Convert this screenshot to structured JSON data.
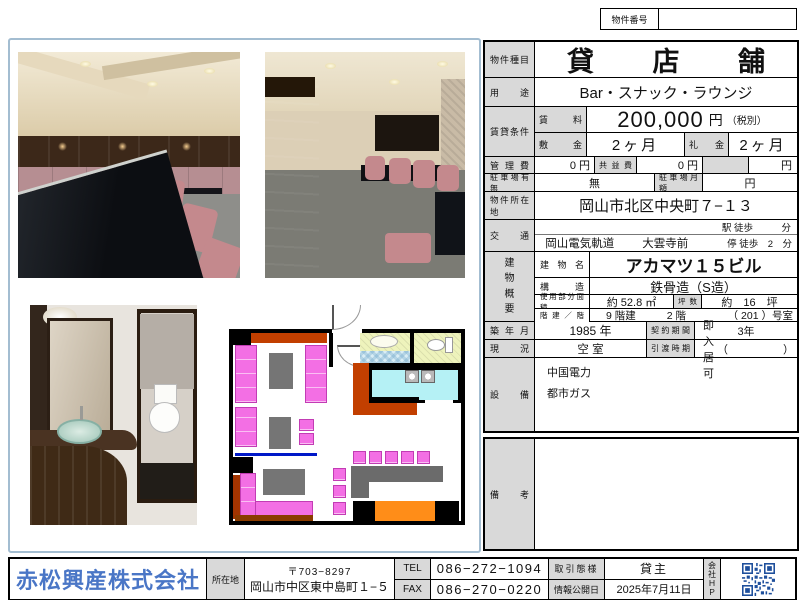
{
  "property_number": {
    "label": "物件番号",
    "value": ""
  },
  "spec": {
    "type_label": "物件種目",
    "type_value": "貸店舗",
    "use_label": "用途",
    "use_value": "Bar・スナック・ラウンジ",
    "rent_label": "賃貸条件",
    "rent_sub_label": "賃料",
    "rent_amount": "200,000",
    "rent_unit": "円",
    "rent_tax_note": "（税別）",
    "deposit_label": "敷金",
    "deposit_value": "2ヶ月",
    "key_money_label": "礼金",
    "key_money_value": "2ヶ月",
    "mgmt_label": "管理費",
    "mgmt_value": "0 円",
    "common_label": "共益費",
    "common_value": "0 円",
    "extra_unit": "円",
    "parking_label": "駐車場有無",
    "parking_value": "無",
    "parking_fee_label": "駐車場月額",
    "parking_fee_unit": "円",
    "address_label": "物件所在地",
    "address_value": "岡山市北区中央町７−１３",
    "access_label": "交通",
    "access_line1_right": "駅 徒歩　　　分",
    "access_line2_company": "岡山電気軌道",
    "access_line2_station": "大雲寺前",
    "access_line2_right": "停 徒歩　2　分",
    "building_vertical": "建\n物\n概\n要",
    "building_name_label": "建物名",
    "building_name_value": "アカマツ１５ビル",
    "structure_label": "構造",
    "structure_value": "鉄骨造（S造）",
    "area_label": "使用部分面積",
    "area_value": "約 52.8 ㎡",
    "tsubo_label": "坪数",
    "tsubo_value": "約　16　坪",
    "floors_label": "階建／階",
    "floors_building": "9 階建",
    "floors_unit_floor": "2 階",
    "floors_room": "（ 201 ）号室",
    "built_label": "築年月",
    "built_value": "1985 年",
    "contract_label": "契約期間",
    "contract_value": "3年",
    "status_label": "現況",
    "status_value": "空 室",
    "handover_label": "引渡時期",
    "handover_value": "即入居可",
    "handover_paren": "（　　　　　）",
    "equipment_label": "設備",
    "equipment_lines": [
      "中国電力",
      "都市ガス"
    ],
    "remarks_label": "備考",
    "remarks_value": ""
  },
  "footer": {
    "company_name": "赤松興産株式会社",
    "office_label": "所在地",
    "postal": "〒703−8297",
    "office_address": "岡山市中区東中島町１−５",
    "tel_label": "TEL",
    "tel_value": "086−272−1094",
    "fax_label": "FAX",
    "fax_value": "086−270−0220",
    "deal_type_label": "取引態様",
    "deal_type_value": "貸主",
    "publish_label": "情報公開日",
    "publish_value": "2025年7月11日",
    "hp_label": "会\n社\nＨ\nＰ"
  },
  "colors": {
    "company_blue": "#4a76c6",
    "qr_blue": "#1e4f9c",
    "label_gray": "#d9d9d9",
    "plan_sofa_pink": "#f36fe4",
    "plan_mat_orange": "#ff8d18",
    "plan_kitchen_cyan": "#b5f1f5",
    "plan_rust": "#c23f00",
    "panel_border": "#a3bdd1"
  }
}
